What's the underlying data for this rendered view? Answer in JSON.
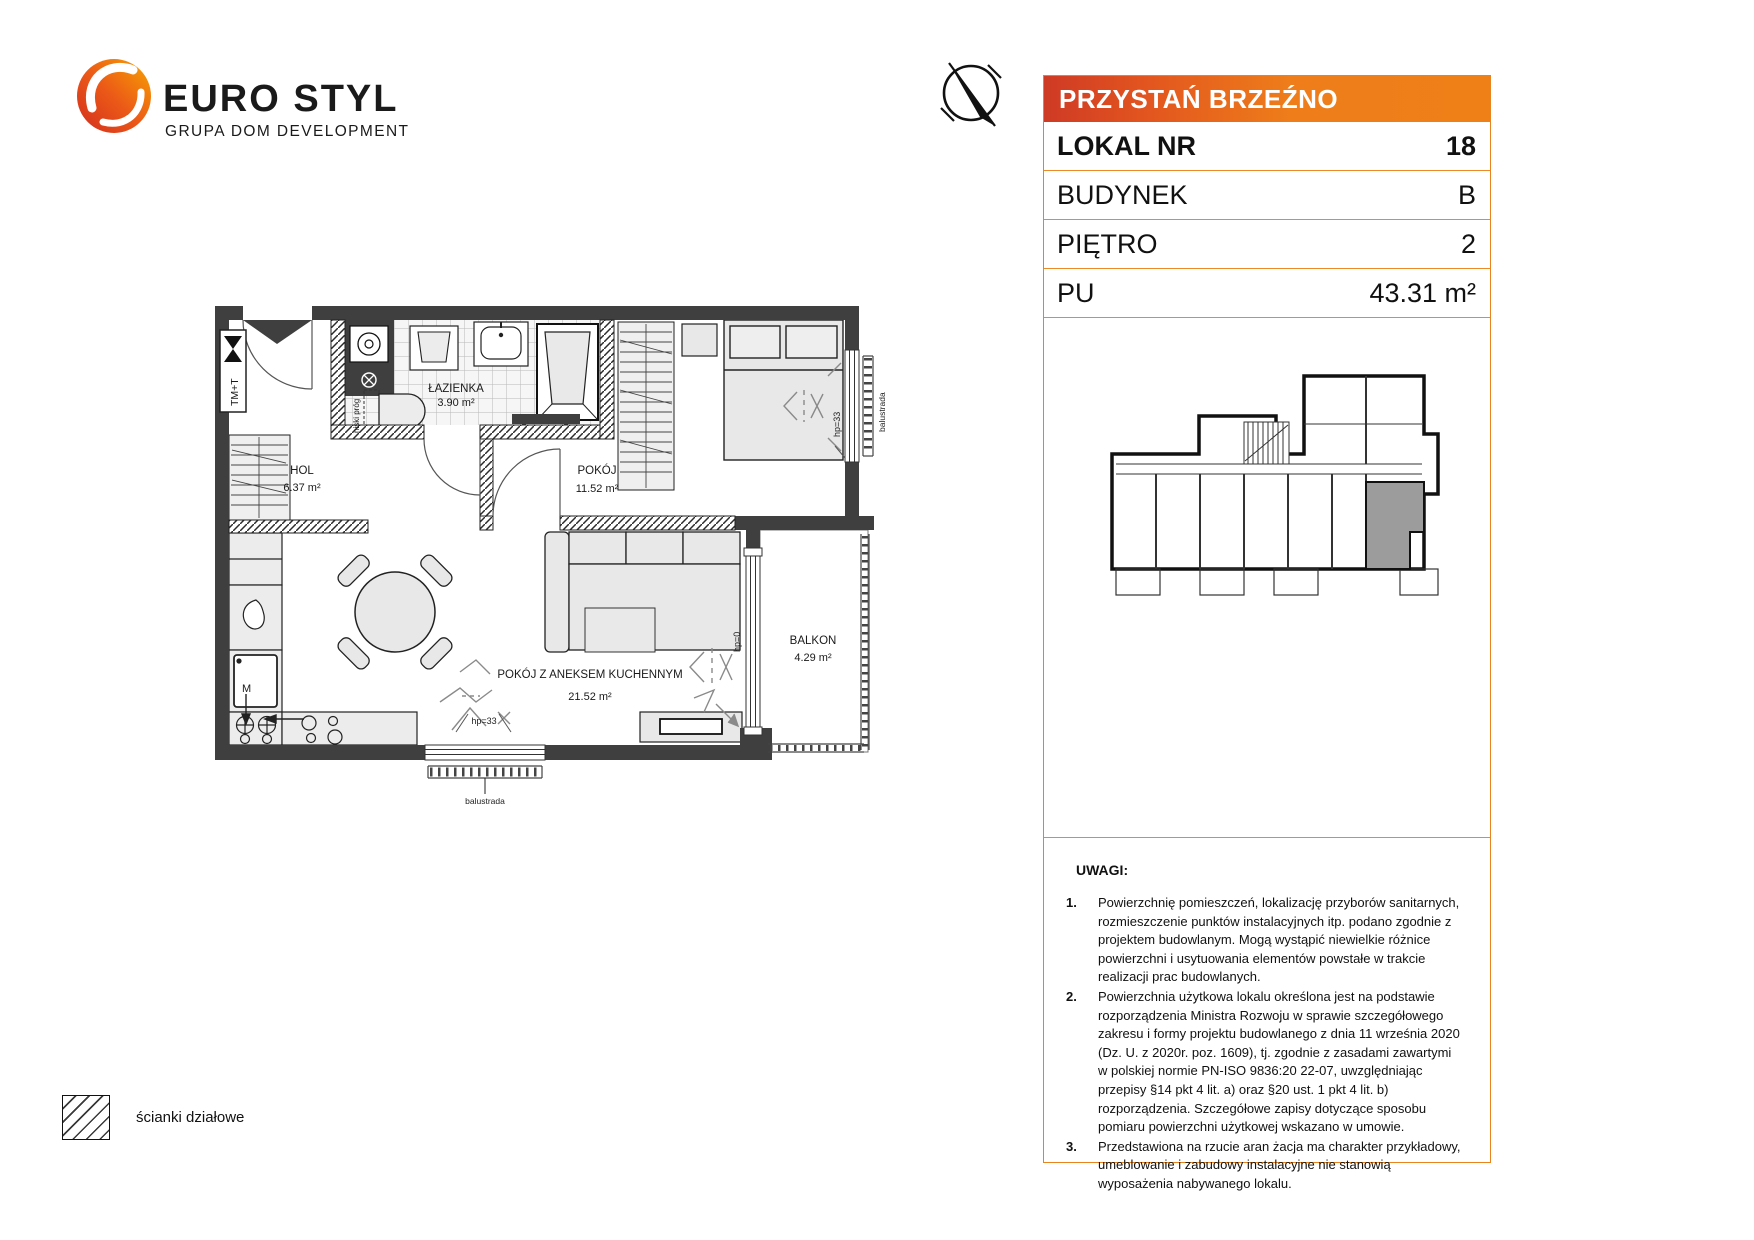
{
  "brand": {
    "name": "EURO STYL",
    "tagline": "GRUPA DOM DEVELOPMENT"
  },
  "header": {
    "project": "PRZYSTAŃ BRZEŹNO",
    "rows": [
      {
        "label": "LOKAL NR",
        "value": "18"
      },
      {
        "label": "BUDYNEK",
        "value": "B"
      },
      {
        "label": "PIĘTRO",
        "value": "2"
      },
      {
        "label": "PU",
        "value": "43.31 m²"
      }
    ]
  },
  "floorplan": {
    "rooms": [
      {
        "name": "ŁAZIENKA",
        "area": "3.90 m²"
      },
      {
        "name": "HOL",
        "area": "6.37 m²"
      },
      {
        "name": "POKÓJ",
        "area": "11.52 m²"
      },
      {
        "name": "POKÓJ Z ANEKSEM KUCHENNYM",
        "area": "21.52 m²"
      },
      {
        "name": "BALKON",
        "area": "4.29 m²"
      }
    ],
    "annotations": {
      "balustrade_bottom": "balustrada",
      "balustrade_right": "balustrada",
      "hp33_bottom": "hp=33",
      "hp33_right": "hp=33",
      "hp0": "hp=0",
      "tmt": "TM+T",
      "low_threshold": "niski próg",
      "m_appliance": "M"
    },
    "legend": {
      "partition_walls": "ścianki działowe"
    }
  },
  "notes": {
    "title": "UWAGI:",
    "items": [
      {
        "num": "1.",
        "text": "Powierzchnię pomieszczeń, lokalizację przyborów sanitarnych, rozmieszczenie punktów instalacyjnych itp. podano zgodnie z projektem budowlanym. Mogą wystąpić niewielkie różnice powierzchni i usytuowania elementów powstałe w trakcie realizacji prac budowlanych."
      },
      {
        "num": "2.",
        "text": "Powierzchnia użytkowa lokalu określona jest na podstawie rozporządzenia Ministra Rozwoju w sprawie szczegółowego zakresu i formy projektu budowlanego z dnia 11 września 2020 (Dz. U. z 2020r. poz. 1609), tj. zgodnie z zasadami zawartymi w polskiej normie PN-ISO 9836:20 22-07, uwzględniając przepisy §14 pkt 4 lit. a) oraz §20 ust. 1 pkt 4 lit. b) rozporządzenia. Szczegółowe zapisy dotyczące sposobu pomiaru powierzchni użytkowej wskazano w umowie."
      },
      {
        "num": "3.",
        "text": "Przedstawiona na rzucie aran żacja ma charakter przykładowy, umeblowanie i zabudowy instalacyjne nie stanowią wyposażenia nabywanego lokalu."
      }
    ]
  },
  "colors": {
    "accent_orange": "#E8831E",
    "header_gradient_left": "#CE3A25",
    "header_gradient_right": "#EE7D1A",
    "wall": "#3F3F3F",
    "unit_highlight": "#9C9C9C"
  }
}
